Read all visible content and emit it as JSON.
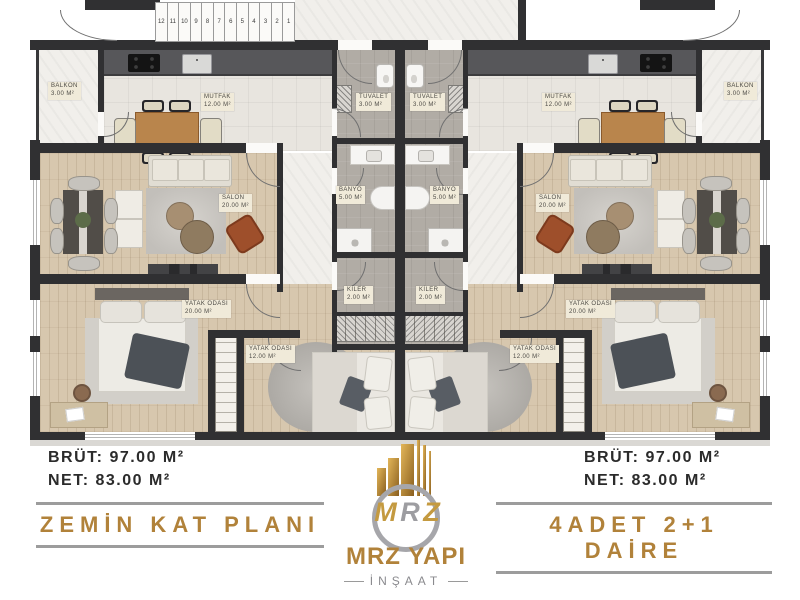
{
  "plan": {
    "stair_numbers": [
      "12",
      "11",
      "10",
      "9",
      "8",
      "7",
      "6",
      "5",
      "4",
      "3",
      "2",
      "1"
    ],
    "rooms": {
      "balkon": {
        "name": "BALKON",
        "area": "3.00 M²"
      },
      "mutfak": {
        "name": "MUTFAK",
        "area": "12.00 M²"
      },
      "salon": {
        "name": "SALON",
        "area": "20.00 M²"
      },
      "yatak_buyuk": {
        "name": "YATAK ODASI",
        "area": "20.00 M²"
      },
      "yatak_kucuk": {
        "name": "YATAK ODASI",
        "area": "12.00 M²"
      },
      "tuvalet": {
        "name": "TUVALET",
        "area": "3.00 M²"
      },
      "banyo": {
        "name": "BANYO",
        "area": "5.00 M²"
      },
      "kiler": {
        "name": "KİLER",
        "area": "2.00 M²"
      }
    }
  },
  "left_block": {
    "brut": "BRÜT: 97.00 M²",
    "net": "NET: 83.00 M²",
    "title": "ZEMİN KAT PLANI"
  },
  "right_block": {
    "brut": "BRÜT: 97.00 M²",
    "net": "NET: 83.00 M²",
    "title": "4ADET 2+1 DAİRE"
  },
  "logo": {
    "icon": "gold-buildings-icon",
    "monogram_m": "M",
    "monogram_r": "R",
    "monogram_z": "Z",
    "name": "MRZ YAPI",
    "subtitle": "İNŞAAT"
  },
  "colors": {
    "gold": "#b1823a",
    "dark_text": "#2b2b2b",
    "rule_gray": "#9c9c9c",
    "wall": "#303032"
  }
}
